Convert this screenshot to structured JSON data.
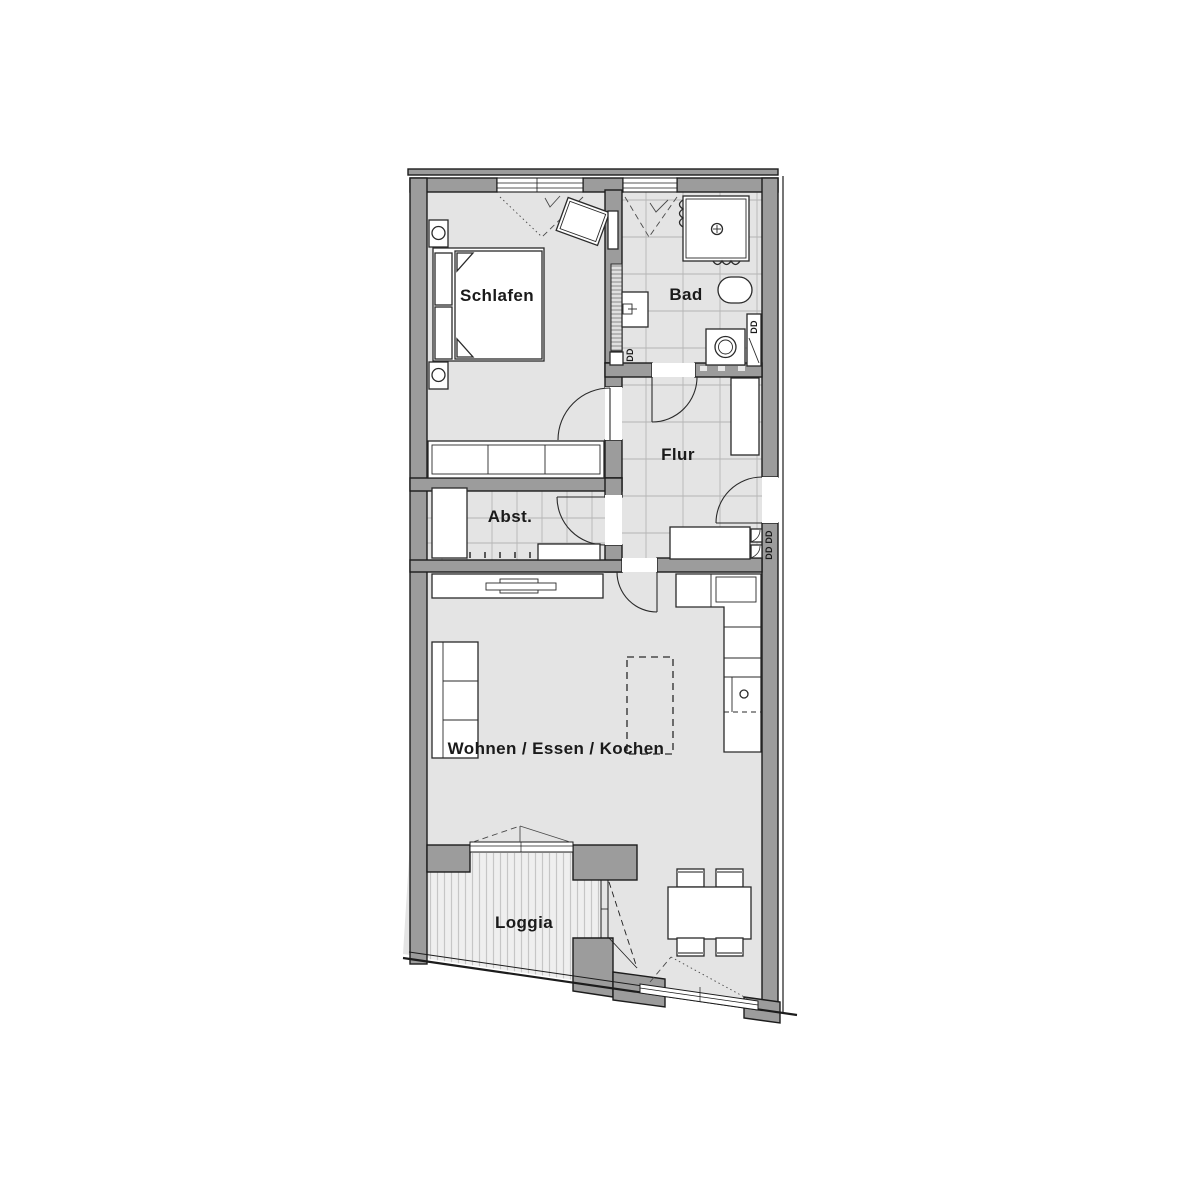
{
  "floorplan": {
    "rooms": [
      {
        "id": "schlafen",
        "label": "Schlafen"
      },
      {
        "id": "bad",
        "label": "Bad"
      },
      {
        "id": "flur",
        "label": "Flur"
      },
      {
        "id": "abstellraum",
        "label": "Abst."
      },
      {
        "id": "wohnen_essen_kochen",
        "label": "Wohnen / Essen / Kochen"
      },
      {
        "id": "loggia",
        "label": "Loggia"
      }
    ],
    "duct_labels": {
      "bad_shaft": "DD",
      "bad_corner": "DD",
      "entry_shaft": "DD DD"
    },
    "colors": {
      "wall": "#9c9c9c",
      "outline": "#1c1c1c",
      "floor": "#e4e4e4",
      "tile_line": "#b5b5b5",
      "loggia_floor": "#efefef",
      "loggia_stripe": "#c6c6c6",
      "furniture_fill": "#ffffff",
      "label_text": "#1a1a1a"
    },
    "fixtures": [
      "double-bed",
      "nightstand",
      "wardrobe",
      "armchair",
      "shower",
      "washbasin",
      "toilet",
      "washing-machine",
      "hall-closet",
      "sideboard",
      "tv-lowboard",
      "sofa",
      "kitchen-counter",
      "kitchen-island-dashed",
      "dining-table",
      "dining-chair"
    ]
  }
}
